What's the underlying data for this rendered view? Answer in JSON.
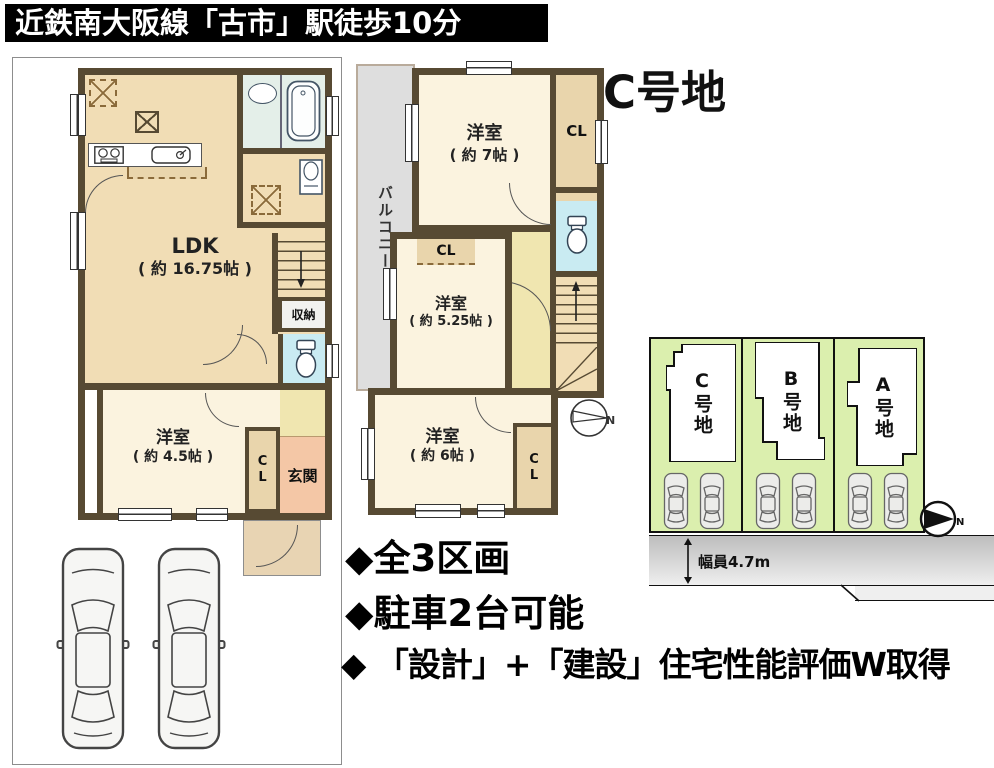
{
  "banner": {
    "text": "近鉄南大阪線「古市」駅徒歩10分"
  },
  "lot_title": "C号地",
  "floor1": {
    "ldk": {
      "name": "LDK",
      "size": "( 約 16.75帖 )"
    },
    "bedroom": {
      "name": "洋室",
      "size": "( 約 4.5帖 )"
    },
    "closet": "CL",
    "entrance": "玄関",
    "storage": "収納"
  },
  "floor2": {
    "balcony": "バルコニー",
    "bedroom_top": {
      "name": "洋室",
      "size": "( 約 7帖 )"
    },
    "closet_top": "CL",
    "closet_mid": "CL",
    "bedroom_mid": {
      "name": "洋室",
      "size": "( 約 5.25帖 )"
    },
    "bedroom_bottom": {
      "name": "洋室",
      "size": "( 約 6帖 )"
    },
    "closet_bottom": "CL"
  },
  "site_plan": {
    "lots": [
      {
        "label": "C号地"
      },
      {
        "label": "B号地"
      },
      {
        "label": "A号地"
      }
    ],
    "road_width_label": "幅員4.7m",
    "north_mark": "N"
  },
  "features": [
    "◆全3区画",
    "◆駐車2台可能",
    "◆ 「設計」+「建設」住宅性能評価W取得"
  ],
  "colors": {
    "wall": "#574A33",
    "floor_tan": "#F1DDB5",
    "room_cream": "#FBF3DF",
    "bath_green": "#E4EFE9",
    "toilet_blue": "#C9EBF2",
    "hall_yellow": "#F0E6B0",
    "entrance_salmon": "#F4C7A6",
    "porch_beige": "#E8D4B3",
    "closet_tan": "#E9D5AC",
    "balcony_gray": "#DEDEDE",
    "lot_green": "#DBEFAE",
    "banner_bg": "#000000",
    "banner_text": "#FFFFFF"
  }
}
